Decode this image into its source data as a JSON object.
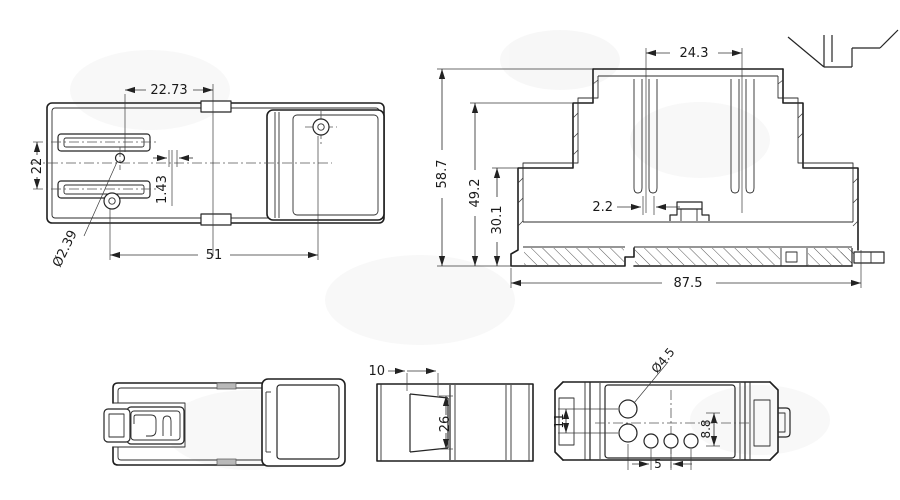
{
  "views": {
    "plan": {
      "dims": {
        "pitch": "22.73",
        "height": "22",
        "offset": "1.43",
        "hole_dia": "Ø2.39",
        "length": "51"
      }
    },
    "section": {
      "dims": {
        "pin_span": "24.3",
        "total_height": "58.7",
        "upper_height": "49.2",
        "base_height": "30.1",
        "slot_width": "2.2",
        "width": "87.5"
      }
    },
    "end": {
      "dims": {
        "depth": "10",
        "window_height": "26"
      }
    },
    "bottom": {
      "dims": {
        "slot_height": "11",
        "hole_dia": "Ø4.5",
        "row_offset": "8.8",
        "hole_pitch": "5"
      }
    }
  }
}
